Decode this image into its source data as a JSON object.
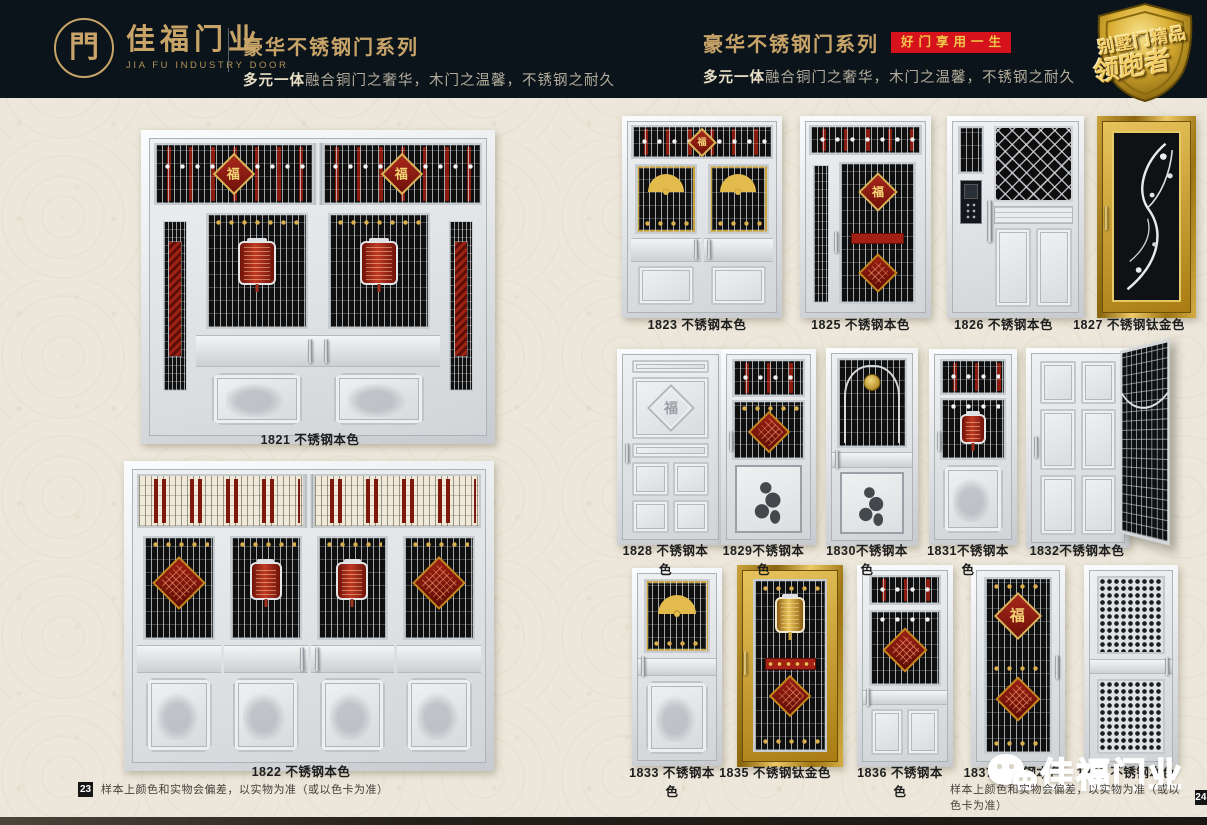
{
  "colors": {
    "header_bg": "#0a141a",
    "gold": "#c9a469",
    "badge_red": "#d6131c",
    "page_bg": "#ece7da",
    "ornament_red": "#8c1b0f",
    "titanium_gold": "#caa23c"
  },
  "header": {
    "logo_glyph": "門",
    "brand_name": "佳福门业",
    "brand_name_en": "JIA FU INDUSTRY DOOR",
    "series_left": {
      "title": "豪华不锈钢门系列",
      "subtitle_em": "多元一体",
      "subtitle_rest": "融合铜门之奢华，木门之温馨，不锈钢之耐久"
    },
    "series_right": {
      "title": "豪华不锈钢门系列",
      "badge": "好门享用一生",
      "subtitle_em": "多元一体",
      "subtitle_rest": "融合铜门之奢华，木门之温馨，不锈钢之耐久"
    },
    "corner_badge": {
      "line1": "别墅门精品",
      "line2": "领跑者"
    }
  },
  "ornament_glyphs": {
    "fu": "福"
  },
  "left_page": {
    "products": [
      {
        "model": "1821",
        "label": "1821 不锈钢本色"
      },
      {
        "model": "1822",
        "label": "1822 不锈钢本色"
      }
    ],
    "footer": {
      "page_number": "23",
      "note": "样本上颜色和实物会偏差，以实物为准（或以色卡为准）"
    }
  },
  "right_page": {
    "products": [
      {
        "model": "1823",
        "label": "1823 不锈钢本色"
      },
      {
        "model": "1825",
        "label": "1825 不锈钢本色"
      },
      {
        "model": "1826",
        "label": "1826 不锈钢本色"
      },
      {
        "model": "1827",
        "label": "1827 不锈钢钛金色"
      },
      {
        "model": "1828",
        "label": "1828 不锈钢本色"
      },
      {
        "model": "1829",
        "label": "1829不锈钢本色"
      },
      {
        "model": "1830",
        "label": "1830不锈钢本色"
      },
      {
        "model": "1831",
        "label": "1831不锈钢本色"
      },
      {
        "model": "1832",
        "label": "1832不锈钢本色"
      },
      {
        "model": "1833",
        "label": "1833 不锈钢本色"
      },
      {
        "model": "1835",
        "label": "1835 不锈钢钛金色"
      },
      {
        "model": "1836",
        "label": "1836 不锈钢本色"
      },
      {
        "model": "1837",
        "label": "1837 不锈钢本色"
      },
      {
        "model": "1838",
        "label": "1838 不锈钢本色"
      }
    ],
    "footer": {
      "page_number": "24",
      "note": "样本上颜色和实物会偏差，以实物为准（或以色卡为准）"
    },
    "watermark": {
      "icon": "wechat-icon",
      "text": "佳福门业"
    }
  }
}
